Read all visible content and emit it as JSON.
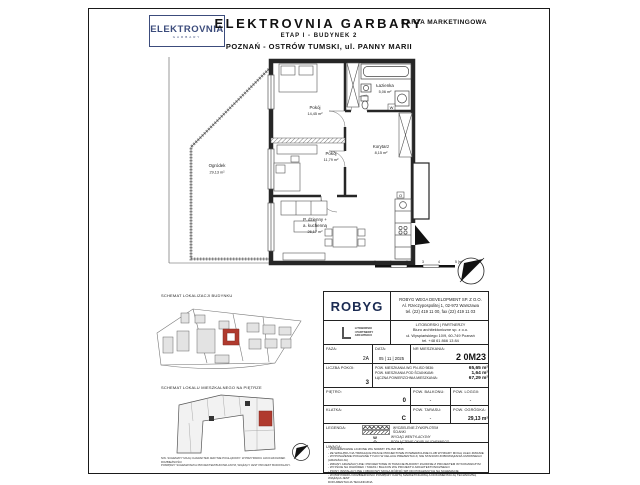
{
  "header": {
    "logo_line1": "ELEKTROVNIA",
    "logo_line2": "GARBARY",
    "title": "ELEKTROVNIA GARBARY",
    "subtitle": "ETAP I - BUDYNEK 2",
    "location": "POZNAŃ - OSTRÓW TUMSKI, ul. PANNY MARII",
    "doc_type": "KARTA MARKETINGOWA",
    "logo_color": "#3c4c7c"
  },
  "floorplan": {
    "rooms": {
      "bedroom1": {
        "name": "Pokój",
        "area": "14,45 m²"
      },
      "bedroom2": {
        "name": "Pokój",
        "area": "11,79 m²"
      },
      "corridor": {
        "name": "Korytarz",
        "area": "8,15 m²"
      },
      "bathroom": {
        "name": "Łazienka",
        "area": "5,06 m²"
      },
      "living": {
        "name": "P. dzienny +",
        "name2": "a. kuchenną",
        "area": "26,17 m²"
      },
      "garden": {
        "name": "Ogródek",
        "area": "29,13 m²"
      }
    },
    "symbols": {
      "vent": "W",
      "hood": "O"
    },
    "scale_ticks": [
      "0",
      "1",
      "2",
      "3",
      "4",
      "5 [m]"
    ]
  },
  "schematics": {
    "building_label": "SCHEMAT LOKALIZACJI BUDYNKU",
    "floor_label": "SCHEMAT LOKALU MIESZKALNEGO NA PIĘTRZE",
    "note_line1": "NIN. SCHEMATY MAJĄ CHARAKTER JEDYNIE POGLĄDOWY. W PRZYPADKU JAKICHKOLWIEK ROZBIEŻNOŚCI",
    "note_line2": "POMIĘDZY SCHEMATAMI A PROJEKTEM BUDOWLANYM, WIĄŻĄCY JEST PROJEKT BUDOWLANY.",
    "highlight_color": "#b03a2e"
  },
  "developer": {
    "logo": "ROBYG",
    "line1": "ROBYG WEGA DEVELOPMENT SP. Z O.O.",
    "line2": "Al. Rzeczypospolitej 1, 02-972 Warszawa",
    "line3": "tel. (22) 419 11 00, fax (22) 419 11 03"
  },
  "architect": {
    "logo_line1": "LITOBORSKI",
    "logo_line2": "I PARTNERZY",
    "logo_line3": "ARCHITEKCI",
    "line1": "LITOBORSKI | PARTNERZY",
    "line2": "Biuro architektoniczne sp. z o.o.",
    "line3": "ul. Wyspiańskiego 10/9, 60-749 Poznań",
    "line4": "tel. +48 61 866 13 84"
  },
  "details": {
    "faza_label": "FAZA:",
    "faza": "2A",
    "data_label": "DATA:",
    "data": "05 | 11 | 2025",
    "nr_label": "NR MIESZKANIA:",
    "nr": "2 0M23",
    "liczba_pokoi_label": "LICZBA POKOI:",
    "liczba_pokoi": "3",
    "pow1_label": "POW. MIESZKANIA WG PN-ISO 9836:",
    "pow1": "65,65 m²",
    "pow2_label": "POW. MIESZKANIA POD ŚCIANKAMI:",
    "pow2": "1,64 m²",
    "pow3_label": "ŁĄCZNA POWIERZCHNIA MIESZKANIA:",
    "pow3": "67,29 m²",
    "pietro_label": "PIĘTRO:",
    "pietro": "0",
    "balkon_label": "POW. BALKONU:",
    "balkon": "-",
    "loggia_label": "POW. LOGGII:",
    "loggia": "-",
    "klatka_label": "KLATKA:",
    "klatka": "C",
    "taras_label": "POW. TARASU:",
    "taras": "-",
    "ogrodek_label": "POW. OGRÓDKA:",
    "ogrodek": "29,13 m²"
  },
  "legend": {
    "label": "LEGENDA:",
    "items": [
      {
        "symbol": "",
        "text": "WYDZIELENIE ŻYWOPŁOTEM"
      },
      {
        "symbol": "",
        "text": "ŚCIANKI"
      },
      {
        "symbol": "W",
        "text": "WYCIĄG WENTYLACYJNY"
      },
      {
        "symbol": "O",
        "text": "PODŁĄCZENIE OKAPU KUCHENNEGO"
      }
    ]
  },
  "uwaga": {
    "label": "UWAGA:",
    "lines": [
      "- POWIERZCHNIE LICZONE WG NORMY PN-ISO 9836",
      "- ZE WZGLĘDU NA TRWAJĄCE PRACE PROJEKTOWE POWIERZCHNIE I/LUB WYMIARY MOGĄ ULEC ZMIANIE",
      "- WYPOSAŻENIE POKAZANE TYLKO W CELACH PREZENTACJI, NIE STANOWI ZOBOWIĄZANIA UMOWNEGO (ARANŻACJA)",
      "- ZMIANY ARANŻACYJNE I PROJEKTOWE W TRAKCIE BUDOWY ZGODNIE Z PROJEKTEM WYKONAWCZYM",
      "- WYJŚCIE NA OGRÓDEK / TARAS / BALKON WG PROJEKTU ARCHITEKTONICZNEGO",
      "- PIONY INSTALACYJNE I OBUDOWY MOGĄ RÓŻNIĆ SIĘ OD POKAZANYCH NA SCHEMACIE",
      "- W PRZYPADKU ROZBIEŻNOŚCI POMIĘDZY KARTĄ MARKETINGOWĄ A DOKUMENTACJĄ TECHNICZNĄ WIĄŻĄCA JEST",
      "  DOKUMENTACJA TECHNICZNA"
    ]
  }
}
